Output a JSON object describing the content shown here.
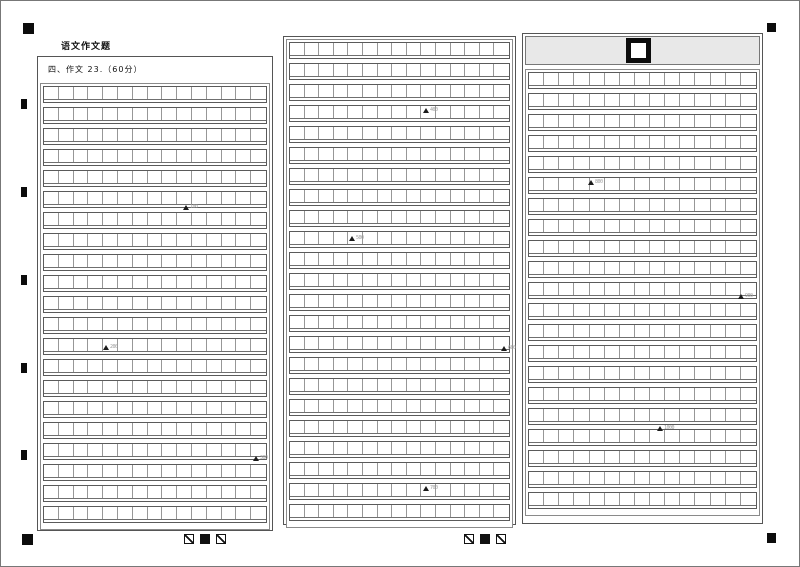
{
  "sheet": {
    "section_title": "语文作文题",
    "question_label": "四、作文 23.（60分）"
  },
  "grids": [
    {
      "name": "essay-grid-page-1",
      "rows": 21,
      "cols": 15,
      "markers": [
        {
          "label": "100",
          "top": 121,
          "left": 142
        },
        {
          "label": "200",
          "top": 261,
          "left": 62
        },
        {
          "label": "300",
          "top": 372,
          "left": 212
        }
      ]
    },
    {
      "name": "essay-grid-page-2",
      "rows": 23,
      "cols": 15,
      "markers": [
        {
          "label": "400",
          "top": 68,
          "left": 136
        },
        {
          "label": "500",
          "top": 196,
          "left": 62
        },
        {
          "label": "600",
          "top": 306,
          "left": 214
        },
        {
          "label": "700",
          "top": 446,
          "left": 136
        }
      ]
    },
    {
      "name": "essay-grid-page-3",
      "rows": 21,
      "cols": 15,
      "markers": [
        {
          "label": "800",
          "top": 110,
          "left": 62
        },
        {
          "label": "900",
          "top": 224,
          "left": 212
        },
        {
          "label": "1000",
          "top": 356,
          "left": 131
        }
      ]
    }
  ],
  "marker_prefix": "▲",
  "footer_icons": [
    "slashed-square-icon",
    "filled-square-icon",
    "slashed-square-icon"
  ],
  "colors": {
    "grid_line": "#979797",
    "frame": "#555555",
    "header_bar_bg": "#e8e8e8",
    "registration_mark": "#0c0c0c"
  }
}
